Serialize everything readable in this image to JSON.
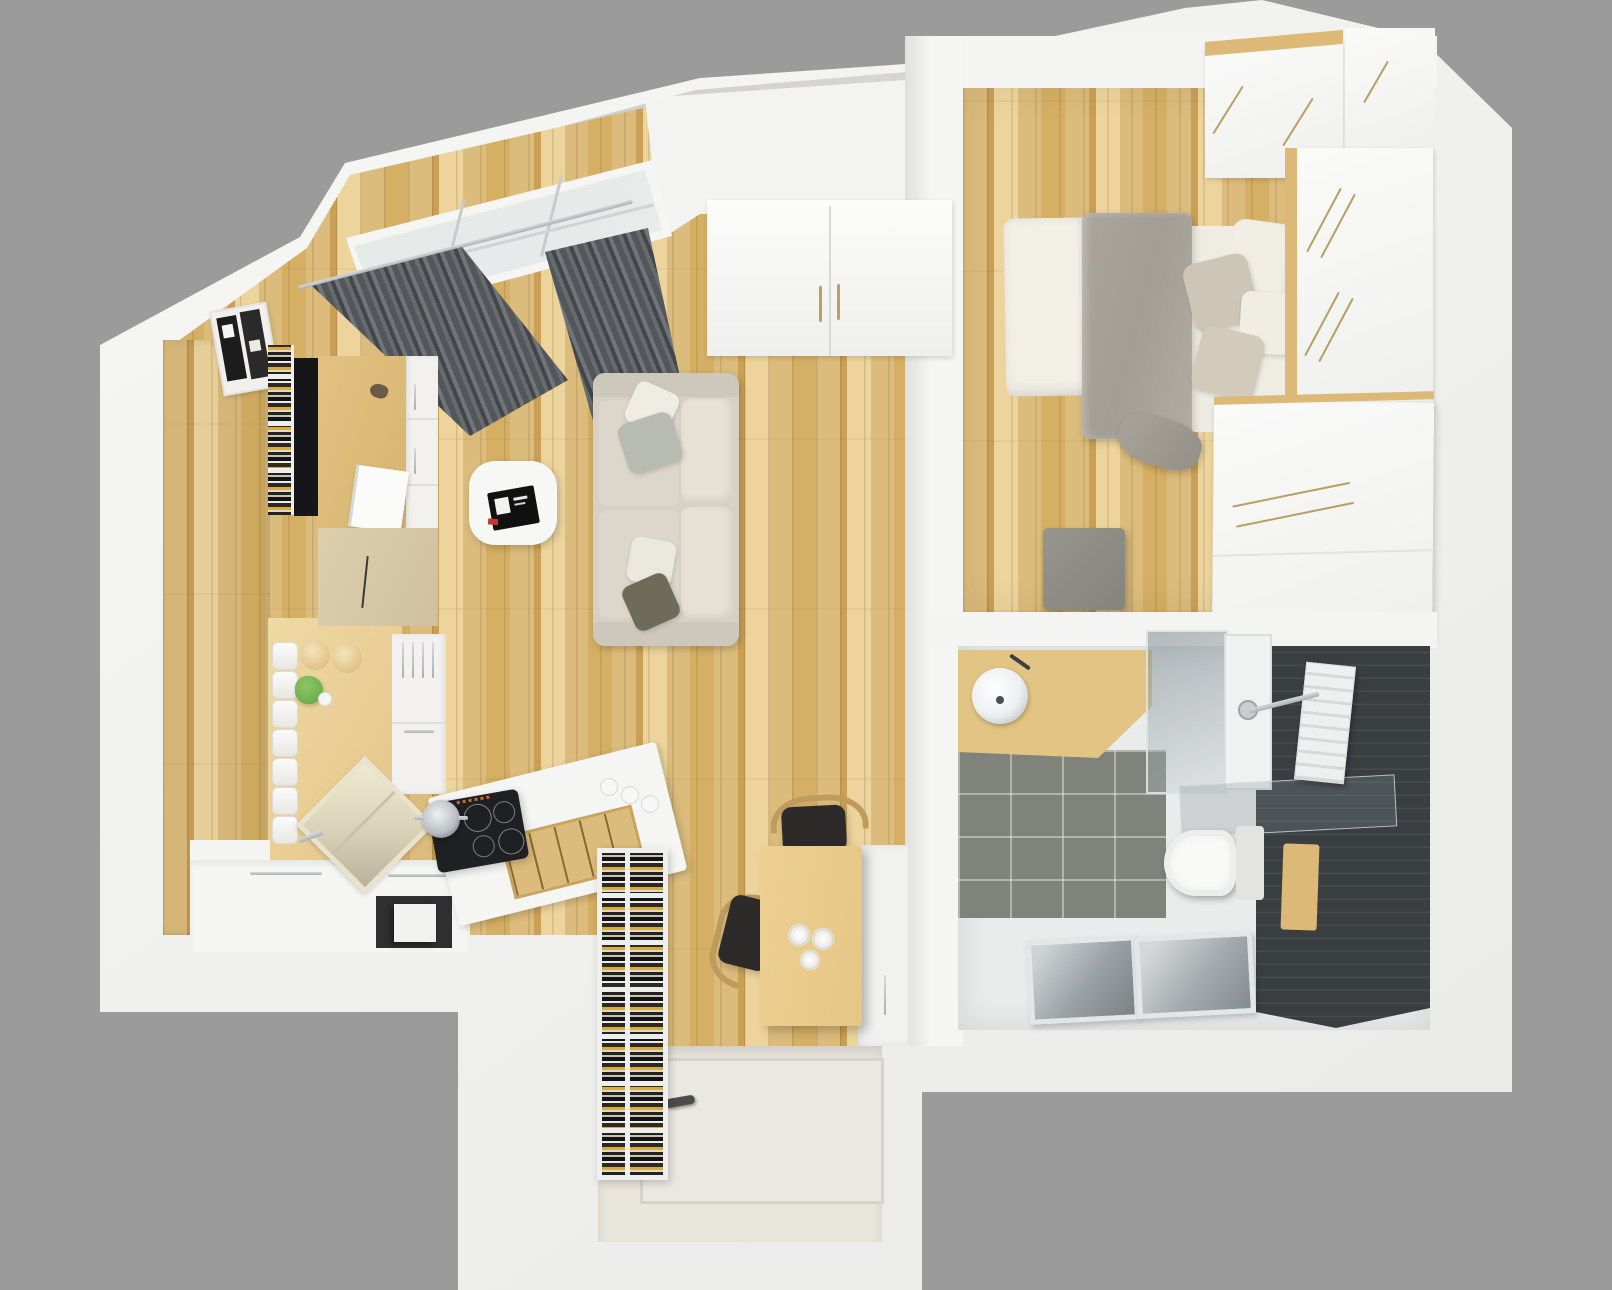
{
  "scene": {
    "description": "Top-down 3D rendering of a compact studio apartment floor plan on a grey backdrop",
    "view": "top-down render",
    "background": "#9b9b9b"
  },
  "palette": {
    "bg": "#9b9b9b",
    "wall": "#f2f2f0",
    "wall_shade": "#e3e3e1",
    "roof_grey": "#cdccc9",
    "wood": "#dcbc7c",
    "wood_dark": "#c9a055",
    "wood_light": "#ecd49c",
    "wood_smooth": "#efd9a4",
    "counter": "#f5f5f3",
    "curtain_dark": "#43464a",
    "curtain_light": "#707579",
    "sofa": "#d7d1c5",
    "cushion": "#e7e1d5",
    "pillow_grey": "#b7bbb2",
    "pillow_olive": "#6f6b59",
    "white_furniture": "#f7f7f5",
    "duvet": "#a29d95",
    "linen": "#f2efe7",
    "tile_dark": "#3a3e41",
    "tile_grey": "#7f837b",
    "bath_floor": "#eaebeb",
    "cooktop": "#1f2023",
    "chair_black": "#2c2b29",
    "chair_wood": "#bf9c5e",
    "steel": "#b9bec1",
    "entry_floor": "#e8e5dd",
    "table_wood": "#e6c685",
    "plant_green": "#6fae4e",
    "book_yellow": "#d8ab3a",
    "brass": "#b99f63"
  },
  "rooms": [
    {
      "name": "living-room",
      "items": [
        "slanted-window",
        "grey-curtains",
        "curtain-rod",
        "beige-sofa",
        "throw-pillows",
        "white-coffee-table",
        "black-magazine",
        "hall-wardrobe",
        "magazine-rack",
        "wall-books",
        "wall-desk",
        "bird-figurine",
        "white-laptop"
      ]
    },
    {
      "name": "kitchen",
      "items": [
        "l-shaped-white-counter",
        "induction-cooktop",
        "steel-pot",
        "diamond-sink",
        "tall-white-unit",
        "open-shelf-canisters",
        "wood-jars",
        "green-plant",
        "spice-rack",
        "white-jars",
        "dark-microwave-niche"
      ]
    },
    {
      "name": "bedroom",
      "items": [
        "double-bed",
        "grey-duvet",
        "white-folded-sheet",
        "pillows",
        "wood-headboard",
        "white-wardrobes",
        "long-brass-handles",
        "grey-ottoman"
      ]
    },
    {
      "name": "bathroom",
      "items": [
        "wood-vanity",
        "round-vessel-sink",
        "glass-shower",
        "shower-tray",
        "lying-glass-panel",
        "towel-radiator",
        "wall-hung-toilet",
        "wood-flush-panel",
        "dark-mosaic-wall",
        "grey-floor-tiles",
        "floor-inspection-hatches"
      ]
    },
    {
      "name": "hallway-entry",
      "items": [
        "dining-table",
        "white-plates",
        "black-wood-chairs",
        "tall-bookcase",
        "entry-door",
        "door-handle",
        "white-side-cabinet"
      ]
    }
  ]
}
